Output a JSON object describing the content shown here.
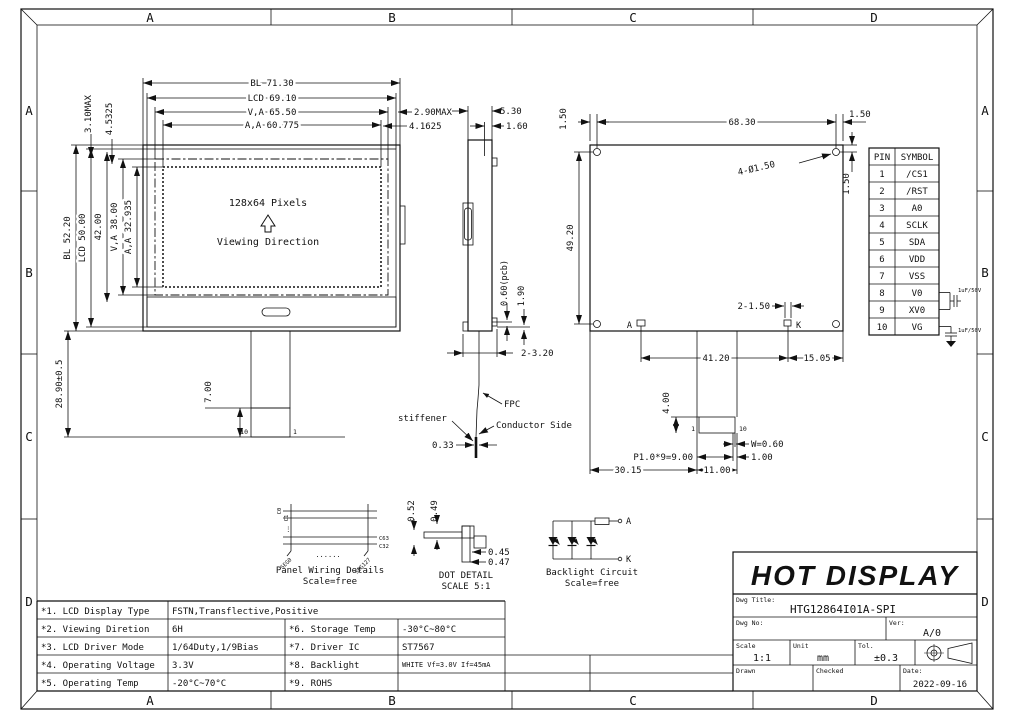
{
  "frame": {
    "top": [
      "A",
      "B",
      "C",
      "D"
    ],
    "bottom": [
      "A",
      "B",
      "C",
      "D"
    ],
    "left": [
      "A",
      "B",
      "C",
      "D"
    ],
    "right": [
      "A",
      "B",
      "C",
      "D"
    ]
  },
  "front": {
    "pixels": "128x64 Pixels",
    "viewing": "Viewing Direction",
    "dim_bl_w": "BL 71.30",
    "dim_lcd_w": "LCD 69.10",
    "dim_va_w": "V,A 65.50",
    "dim_aa_w": "A,A 60.775",
    "dim_290": "2.90MAX",
    "dim_41625": "4.1625",
    "dim_310": "3.10MAX",
    "dim_45325": "4.5325",
    "dim_bl_h": "BL 52.20",
    "dim_lcd_h": "LCD 50.00",
    "dim_42": "42.00",
    "dim_va_h": "V,A 38.00",
    "dim_aa_h": "A,A 32.935",
    "dim_289": "28.90±0.5",
    "dim_7": "7.00",
    "pin10": "10",
    "pin1": "1"
  },
  "side": {
    "dim_530": "5.30",
    "dim_160": "1.60",
    "dim_060": "0.60(pcb)",
    "dim_190": "1.90",
    "dim_2320": "2-3.20",
    "stiffener": "stiffener",
    "fpc": "FPC",
    "conductor": "Conductor Side",
    "dim_033": "0.33"
  },
  "rear": {
    "dim_6830": "68.30",
    "dim_150_left": "1.50",
    "dim_150_right": "1.50",
    "dim_150_vert": "1.50",
    "holes": "4-Ø1.50",
    "dim_4920": "49.20",
    "a": "A",
    "k": "K",
    "dim_2150": "2-1.50",
    "dim_4120": "41.20",
    "dim_1505": "15.05",
    "dim_4": "4.00",
    "pin1": "1",
    "pin10": "10",
    "dim_w": "W=0.60",
    "dim_100": "1.00",
    "dim_pitch": "P1.0*9=9.00",
    "dim_3015": "30.15",
    "dim_1100": "11.00"
  },
  "pin_table": {
    "headers": [
      "PIN",
      "SYMBOL"
    ],
    "rows": [
      [
        "1",
        "/CS1"
      ],
      [
        "2",
        "/RST"
      ],
      [
        "3",
        "A0"
      ],
      [
        "4",
        "SCLK"
      ],
      [
        "5",
        "SDA"
      ],
      [
        "6",
        "VDD"
      ],
      [
        "7",
        "VSS"
      ],
      [
        "8",
        "V0"
      ],
      [
        "9",
        "XV0"
      ],
      [
        "10",
        "VG"
      ]
    ],
    "cap1": "1uF/50V",
    "cap2": "1uF/50V"
  },
  "wiring": {
    "title": "Panel Wiring Details",
    "scale": "Scale=free",
    "c0": "C0",
    "c1": "C1",
    "c63": "C63",
    "c32": "C32",
    "seg0": "SEG0",
    "seg127": "SEG127",
    "dots": "......",
    "vdots": "⋮"
  },
  "dot_detail": {
    "title": "DOT DETAIL",
    "scale": "SCALE 5:1",
    "d052": "0.52",
    "d049": "0.49",
    "d045": "0.45",
    "d047": "0.47"
  },
  "backlight": {
    "title": "Backlight Circuit",
    "scale": "Scale=free",
    "a": "A",
    "k": "K"
  },
  "spec": {
    "rows": [
      {
        "l1": "*1. LCD Display Type",
        "v1": "FSTN,Transflective,Positive"
      },
      {
        "l1": "*2. Viewing Diretion",
        "v1": "6H",
        "l2": "*6. Storage Temp",
        "v2": "-30°C~80°C"
      },
      {
        "l1": "*3. LCD Driver Mode",
        "v1": "1/64Duty,1/9Bias",
        "l2": "*7. Driver IC",
        "v2": "ST7567"
      },
      {
        "l1": "*4. Operating Voltage",
        "v1": "3.3V",
        "l2": "*8. Backlight",
        "v2": "WHITE Vf=3.0V If=45mA"
      },
      {
        "l1": "*5. Operating Temp",
        "v1": "-20°C~70°C",
        "l2": "*9. ROHS",
        "v2": ""
      }
    ]
  },
  "title_block": {
    "company": "HOT DISPLAY",
    "dwg_title_label": "Dwg Title:",
    "dwg_title": "HTG12864I01A-SPI",
    "dwg_no_label": "Dwg No:",
    "ver_label": "Ver:",
    "ver": "A/0",
    "scale_label": "Scale",
    "scale": "1:1",
    "unit_label": "Unit",
    "unit": "mm",
    "tol_label": "Tol.",
    "tol": "±0.3",
    "drawn_label": "Drawn",
    "checked_label": "Checked",
    "date_label": "Date:",
    "date": "2022-09-16"
  }
}
